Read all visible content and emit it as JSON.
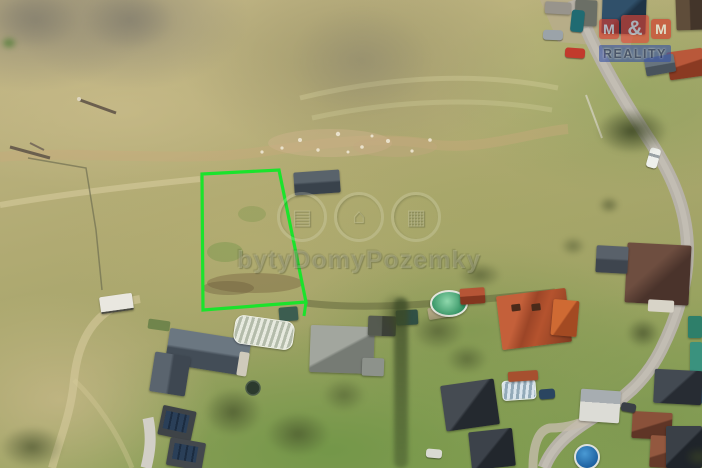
{
  "scene": {
    "description": "Aerial drone photograph of a grassy land plot for sale with highlighted parcel boundary, surrounded by meadows, a road and village houses",
    "parcel": {
      "points": "202,174 279,170 306,302 203,310",
      "stub": "M306,302 L304,316",
      "outline_color": "#1be32c"
    },
    "watermark": {
      "text": "bytyDomyPozemky",
      "icons": [
        {
          "name": "apartments-icon",
          "glyph": "▤"
        },
        {
          "name": "house-icon",
          "glyph": "⌂"
        },
        {
          "name": "land-icon",
          "glyph": "▦"
        }
      ]
    },
    "logo": {
      "tiles": [
        "M",
        "&",
        "M"
      ],
      "banner": "REALITY",
      "tile_color": "#d8372a",
      "banner_color": "#3753a5"
    },
    "colors": {
      "meadow_dry": "#c4b788",
      "meadow_green": "#88a054",
      "road": "#b7b2a8",
      "red_roof": "#b5532e",
      "dark_roof": "#3c424a",
      "pool_water": "#2f8f60"
    }
  }
}
